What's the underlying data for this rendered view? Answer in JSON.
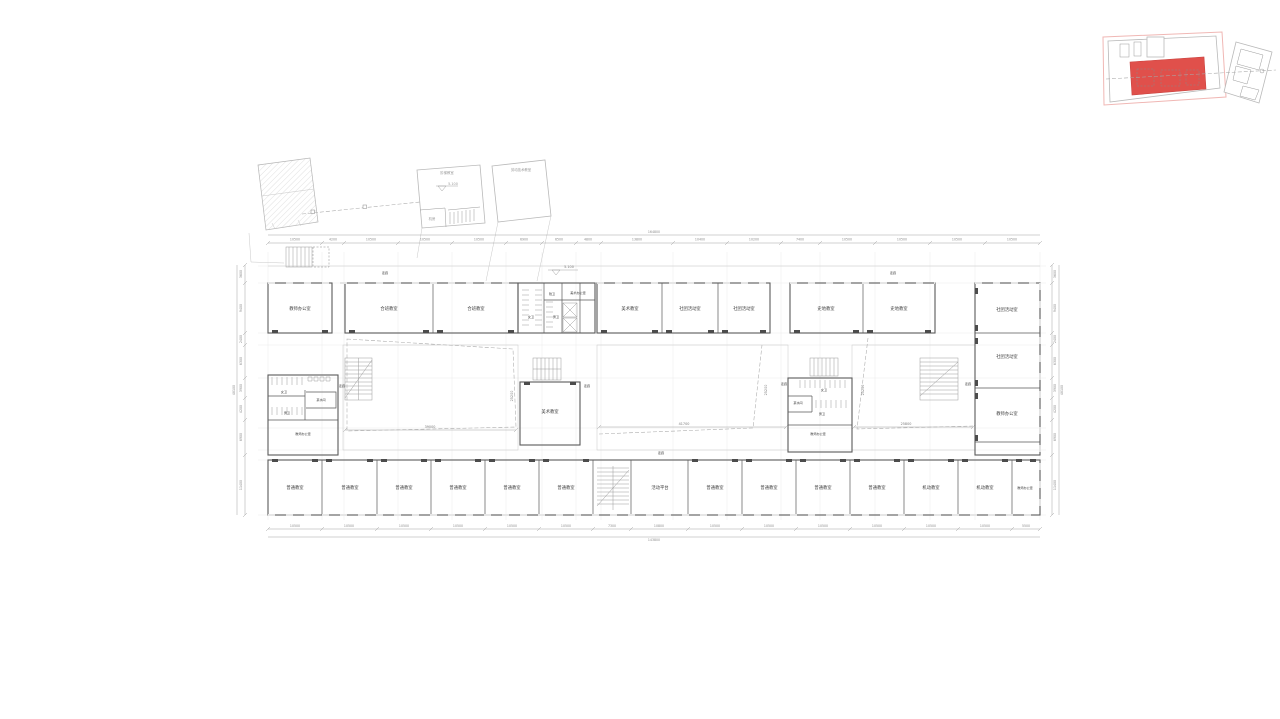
{
  "colors": {
    "accent_red": "#e0504b",
    "boundary_pink": "#f0b7b4",
    "wall": "#5a5a5a",
    "dim_text": "#8c8c8c"
  },
  "context": {
    "building1_label": "阶梯教室",
    "building1_room": "机房",
    "building2_label": "劳动技术教室",
    "elevation": "5.100"
  },
  "plan": {
    "corridor": "走廊",
    "elevation": "5.100",
    "top_left": [
      "教师办公室",
      "合班教室",
      "合班教室"
    ],
    "core_top": {
      "f": "女卫",
      "a": "残卫",
      "m": "男卫",
      "office": "美术办公室"
    },
    "top_mid": [
      "美术教室",
      "社团活动室",
      "社团活动室"
    ],
    "top_right": [
      "史地教室",
      "史地教室"
    ],
    "right_wing": [
      "社团活动室",
      "社团活动室",
      "教师办公室"
    ],
    "core_left": {
      "f": "女卫",
      "tea": "茶水间",
      "m": "男卫",
      "office": "教师办公室"
    },
    "core_right": {
      "f": "女卫",
      "tea": "茶水间",
      "m": "男卫",
      "office": "教师办公室"
    },
    "art_room": "美术教室",
    "bottom": [
      "普通教室",
      "普通教室",
      "普通教室",
      "普通教室",
      "普通教室",
      "普通教室",
      "活动平台",
      "普通教室",
      "普通教室",
      "普通教室",
      "普通教室",
      "机动教室",
      "机动教室",
      "教师办公室"
    ],
    "cy": {
      "left": "39000",
      "mid": "41700",
      "right": "25800",
      "v": "25200"
    }
  },
  "dims": {
    "top": [
      "10500",
      "4200",
      "10500",
      "10500",
      "10500",
      "6900",
      "6500",
      "4800",
      "13800",
      "10400",
      "10200",
      "7400",
      "10500",
      "10500",
      "10500",
      "10500"
    ],
    "top_total": "164800",
    "bottom": [
      "10500",
      "10500",
      "10500",
      "10500",
      "10500",
      "10500",
      "7300",
      "10800",
      "10500",
      "10500",
      "10500",
      "10500",
      "10500",
      "10500",
      "5500"
    ],
    "bottom_total": "143800",
    "left": [
      "3600",
      "9400",
      "2400",
      "6300",
      "3900",
      "4200",
      "6900",
      "11400"
    ],
    "left_total": "48100",
    "right": [
      "3600",
      "9400",
      "2400",
      "6300",
      "3900",
      "4200",
      "6900",
      "11400"
    ],
    "right_total": "48100"
  }
}
